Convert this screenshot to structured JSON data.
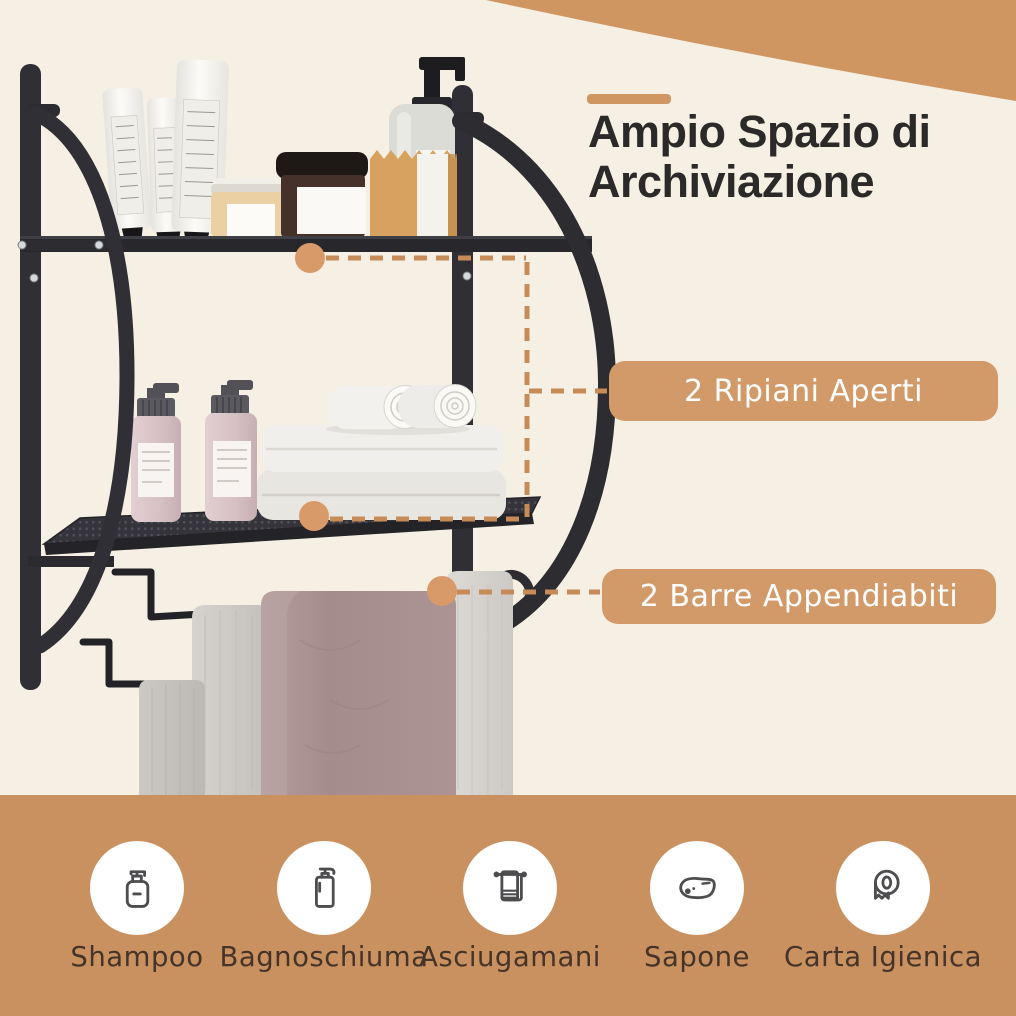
{
  "header": {
    "title": "Ampio Spazio di\nArchiviazione"
  },
  "callouts": [
    {
      "label": "2 Ripiani Aperti"
    },
    {
      "label": "2 Barre Appendiabiti"
    }
  ],
  "features": [
    {
      "icon": "shampoo-bottle-icon",
      "label": "Shampoo"
    },
    {
      "icon": "shower-gel-bottle-icon",
      "label": "Bagnoschiuma"
    },
    {
      "icon": "towel-icon",
      "label": "Asciugamani"
    },
    {
      "icon": "soap-bar-icon",
      "label": "Sapone"
    },
    {
      "icon": "toilet-paper-icon",
      "label": "Carta Igienica"
    }
  ],
  "product": {
    "alt": "Black two-tier wall-mounted bathroom shelf with two open shelves and two towel bars holding toiletries and towels"
  },
  "colors": {
    "background": "#f6efe3",
    "accent": "#cf9662",
    "band": "#ca9160",
    "callout_bg": "#d29a69",
    "callout_text": "#ffffff",
    "title_text": "#2b2a28",
    "feature_label_text": "#463429",
    "frame_black": "#2f2f35",
    "connector_dot": "#d99a6a",
    "connector_dash": "#c78b58",
    "towel_pink": "#a78f90",
    "towel_gray": "#cdc9c5"
  }
}
